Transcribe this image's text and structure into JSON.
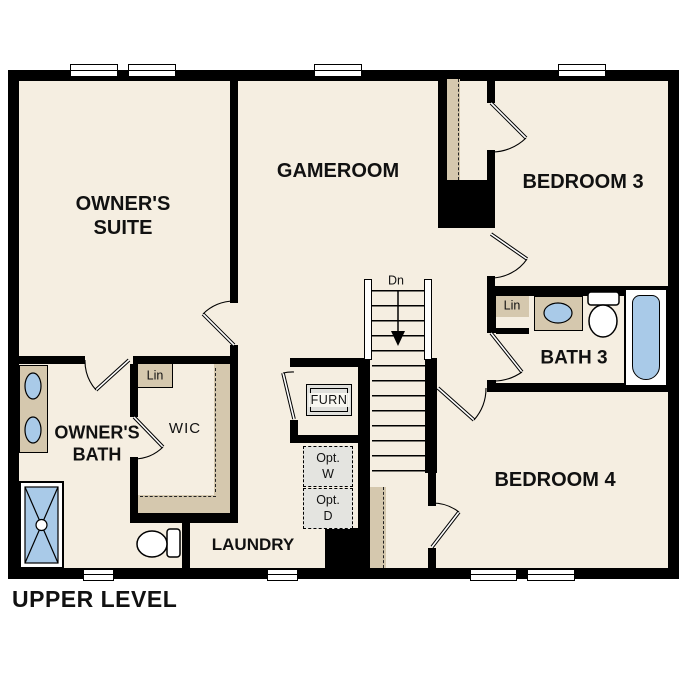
{
  "title": "UPPER LEVEL",
  "rooms": {
    "owners_suite": "OWNER'S SUITE",
    "gameroom": "GAMEROOM",
    "bedroom3": "BEDROOM 3",
    "bedroom4": "BEDROOM 4",
    "bath3": "BATH 3",
    "owners_bath": "OWNER'S BATH",
    "wic": "WIC",
    "laundry": "LAUNDRY"
  },
  "annotations": {
    "stairs_direction": "Dn",
    "linen_wic": "Lin",
    "linen_bath3": "Lin",
    "furnace": "FURN",
    "optional_washer": "Opt. W",
    "optional_dryer": "Opt. D"
  },
  "fixtures": {
    "owners_bath": [
      "double-vanity-sinks",
      "shower",
      "toilet"
    ],
    "bath3": [
      "vanity-sink",
      "toilet",
      "bathtub"
    ],
    "stairs": "staircase-down",
    "laundry": [
      "optional-washer-location",
      "optional-dryer-location"
    ],
    "mechanical": "furnace"
  },
  "colors": {
    "background": "#ffffff",
    "floor": "#f5eee1",
    "wall": "#000000",
    "casework_tan": "#d5c8ae",
    "fixture_blue": "#a9cae8",
    "appliance_gray": "#e4e4e0",
    "text": "#111111"
  }
}
